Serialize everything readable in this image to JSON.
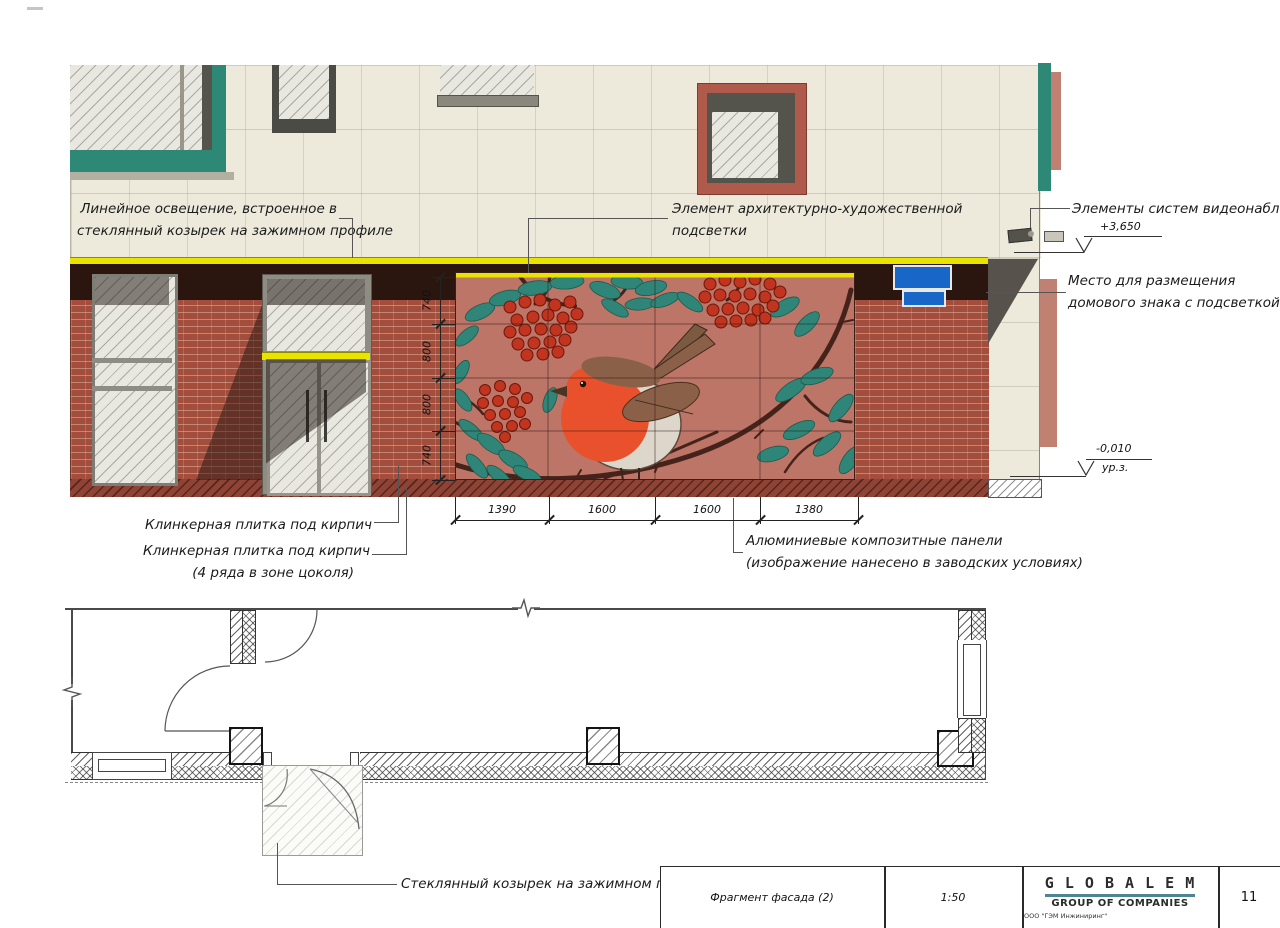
{
  "labels": {
    "linear_lighting": [
      "Линейное освещение, встроенное в",
      "стеклянный козырек на зажимном профиле"
    ],
    "art_lighting": [
      "Элемент архитектурно-художественной",
      "подсветки"
    ],
    "cctv": "Элементы систем видеонаблюдения",
    "house_sign": [
      "Место для размещения",
      "домового знака с подсветкой"
    ],
    "klinker_top": "Клинкерная плитка под кирпич",
    "klinker_socle": [
      "Клинкерная плитка под кирпич",
      "(4 ряда в зоне цоколя)"
    ],
    "alu_panels": [
      "Алюминиевые композитные панели",
      "(изображение нанесено в заводских условиях)"
    ],
    "glass_canopy": "Стеклянный козырек на зажимном профиле"
  },
  "levels": {
    "top": "+3,650",
    "ground": "-0,010",
    "ground_sub": "ур.з."
  },
  "dimensions": {
    "horizontal": [
      "1390",
      "1600",
      "1600",
      "1380"
    ],
    "vertical": [
      "740",
      "800",
      "800",
      "740"
    ]
  },
  "titleblock": {
    "drawing_title": "Фрагмент фасада (2)",
    "scale": "1:50",
    "logo_line1": "G L O B A L   E M",
    "logo_line2": "GROUP OF COMPANIES",
    "company": "ООО \"ГЭМ Инжиниринг\"",
    "sheet_number": "11"
  },
  "colors": {
    "cream": "#edeadc",
    "brick": "#a34e3d",
    "dark_band": "#2b150f",
    "yellow": "#e8e400",
    "teal": "#2d8876",
    "salmon": "#c08173",
    "red_frame": "#b05a4c",
    "mural_bg": "#bd7567",
    "leaf": "#2f8577",
    "berry": "#c1341f",
    "branch": "#45231a",
    "robin_orange": "#e8512b",
    "robin_brown": "#8a6148",
    "robin_belly": "#ddd6cb",
    "sign_blue": "#1766c8",
    "wedge": "#57524c",
    "logo_teal": "#4f8492"
  }
}
